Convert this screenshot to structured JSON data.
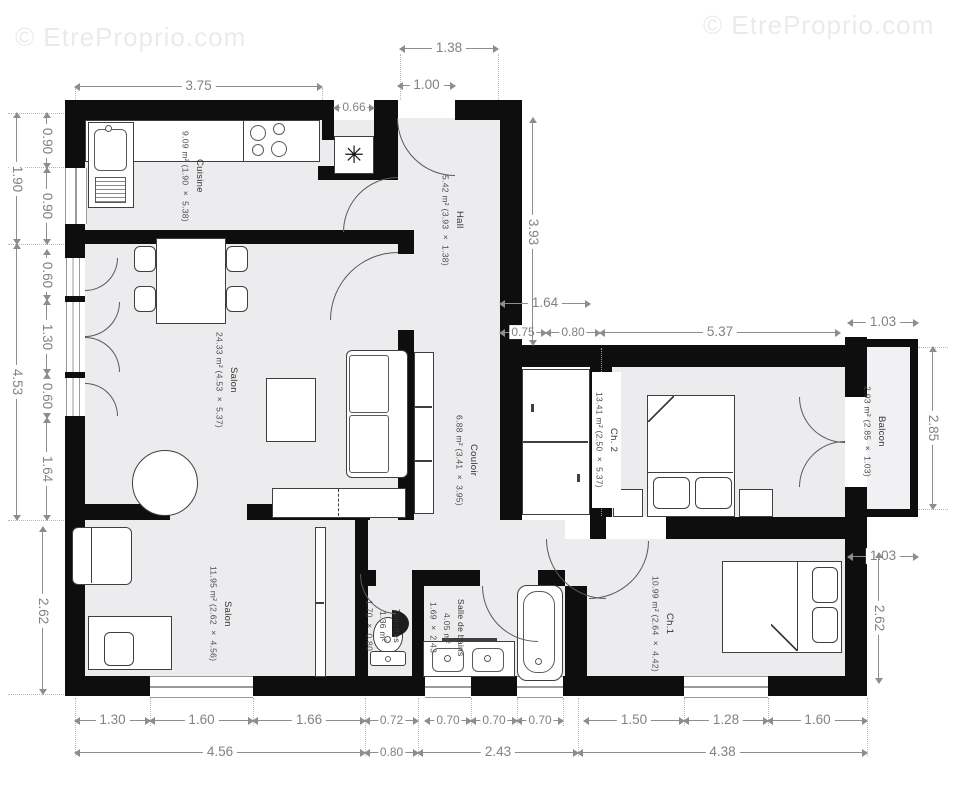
{
  "watermark": {
    "text": "© EtreProprio.com"
  },
  "icons": {
    "vent": "✳"
  },
  "colors": {
    "wall": "#0e0e0e",
    "room_fill": "#ececee",
    "dimension": "#8d8d8d",
    "label": "#333333"
  },
  "rooms": {
    "cuisine": {
      "name": "Cuisine",
      "details": "9.09 m² (1.90 × 5.38)"
    },
    "hall": {
      "name": "Hall",
      "details": "5.42 m² (3.93 × 1.38)"
    },
    "salon": {
      "name": "Salon",
      "details": "24.33 m² (4.53 × 5.37)"
    },
    "couloir": {
      "name": "Couloir",
      "details": "6.88 m² (3.41 × 3.95)"
    },
    "ch2": {
      "name": "Ch. 2",
      "details": "13.41 m² (2.50 × 5.37)"
    },
    "balcon": {
      "name": "Balcon",
      "details": "2.93 m² (2.85 × 1.03)"
    },
    "salon2": {
      "name": "Salon",
      "details": "11.95 m² (2.62 × 4.56)"
    },
    "toilettes": {
      "name": "Toilettes",
      "area": "1.36 m²",
      "size": "1.70 × 0.80"
    },
    "sdb": {
      "name": "Salle de bains",
      "area": "4.05 m²",
      "size": "1.69 × 2.43"
    },
    "ch1": {
      "name": "Ch.1",
      "details": "10.99 m² (2.64 × 4.42)"
    }
  },
  "dims": {
    "k_top": "3.75",
    "ent_outer": "1.38",
    "ent_door": "1.00",
    "vent": "0.66",
    "hall_h": "3.93",
    "cl_top": "1.64",
    "cl_a": "0.75",
    "cl_b": "0.80",
    "ch2_w": "5.37",
    "bal_top": "1.03",
    "bal_h": "2.85",
    "bal_bot": "1.03",
    "ch1_h": "2.62",
    "k_h": "1.90",
    "k_a": "0.90",
    "k_b": "0.90",
    "s_h": "4.53",
    "s_a": "0.60",
    "s_b": "1.30",
    "s_c": "0.60",
    "s_d": "1.64",
    "s2_h": "2.62",
    "b1": "1.30",
    "b2": "1.60",
    "b3": "1.66",
    "b4": "0.72",
    "b5": "0.70",
    "b6": "0.70",
    "b7": "0.70",
    "b8": "1.50",
    "b9": "1.28",
    "b10": "1.60",
    "t1": "4.56",
    "t2": "0.80",
    "t3": "2.43",
    "t4": "4.38"
  }
}
